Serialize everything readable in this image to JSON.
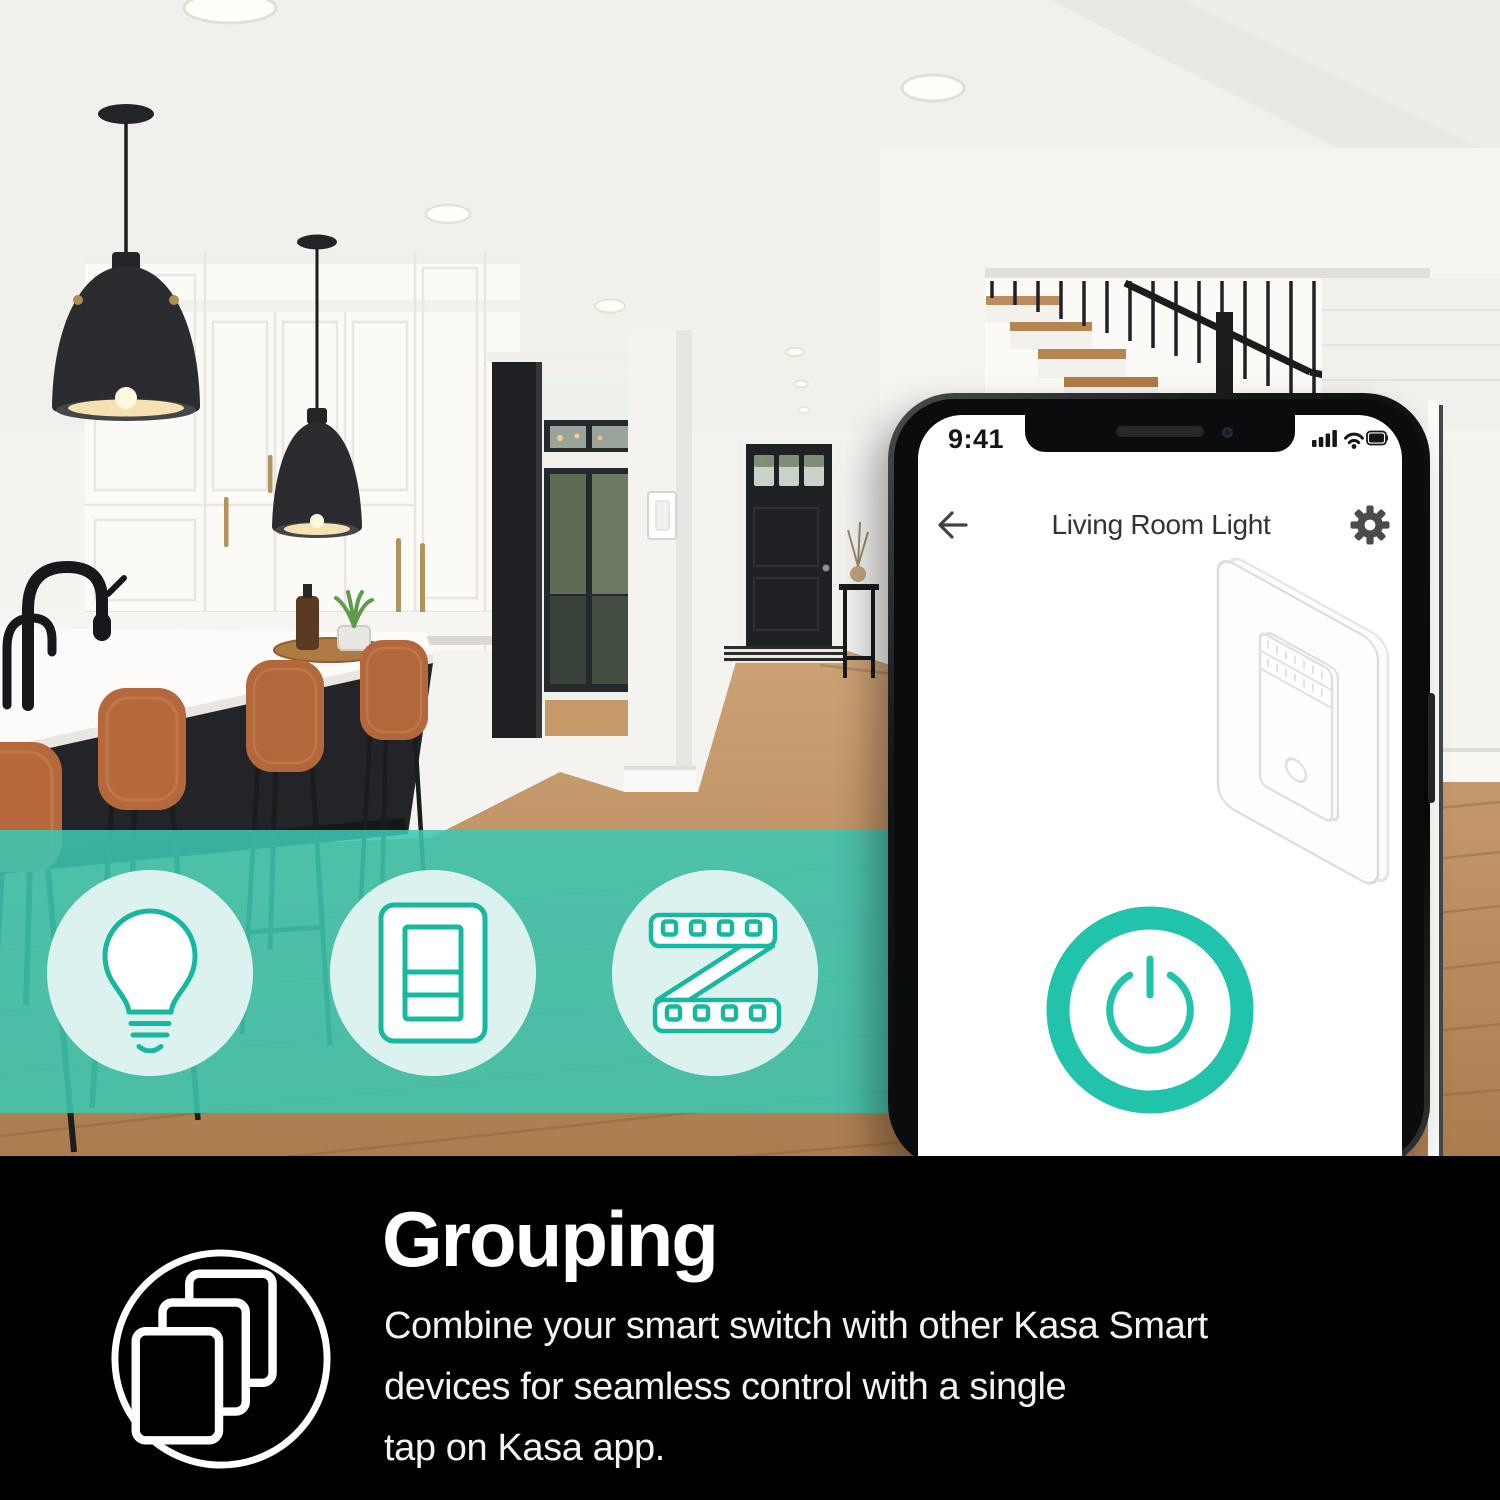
{
  "feature_band": {
    "band_color": "#3ec6b2",
    "icons": [
      {
        "name": "smart-bulb-icon"
      },
      {
        "name": "smart-switch-icon"
      },
      {
        "name": "led-strip-icon"
      }
    ]
  },
  "phone": {
    "status": {
      "time": "9:41",
      "icons": [
        "signal-icon",
        "wifi-icon",
        "battery-icon"
      ]
    },
    "nav": {
      "back_icon": "back-arrow-icon",
      "title": "Living Room Light",
      "settings_icon": "gear-icon"
    },
    "screen": {
      "illustration": "smart-switch-line-drawing",
      "power_icon": "power-icon"
    }
  },
  "footer": {
    "icon": "grouping-icon",
    "heading": "Grouping",
    "body_lines": [
      "Combine your smart switch with other Kasa Smart",
      "devices for seamless control with a single",
      "tap on Kasa app."
    ]
  },
  "colors": {
    "accent_teal": "#21c3ab",
    "band_teal": "#3ec6b2",
    "circle_mint": "#dbf2ee",
    "icon_stroke": "#17b7a0",
    "footer_bg": "#000000",
    "footer_heading": "#ffffff",
    "footer_body": "#f3f3f3"
  }
}
